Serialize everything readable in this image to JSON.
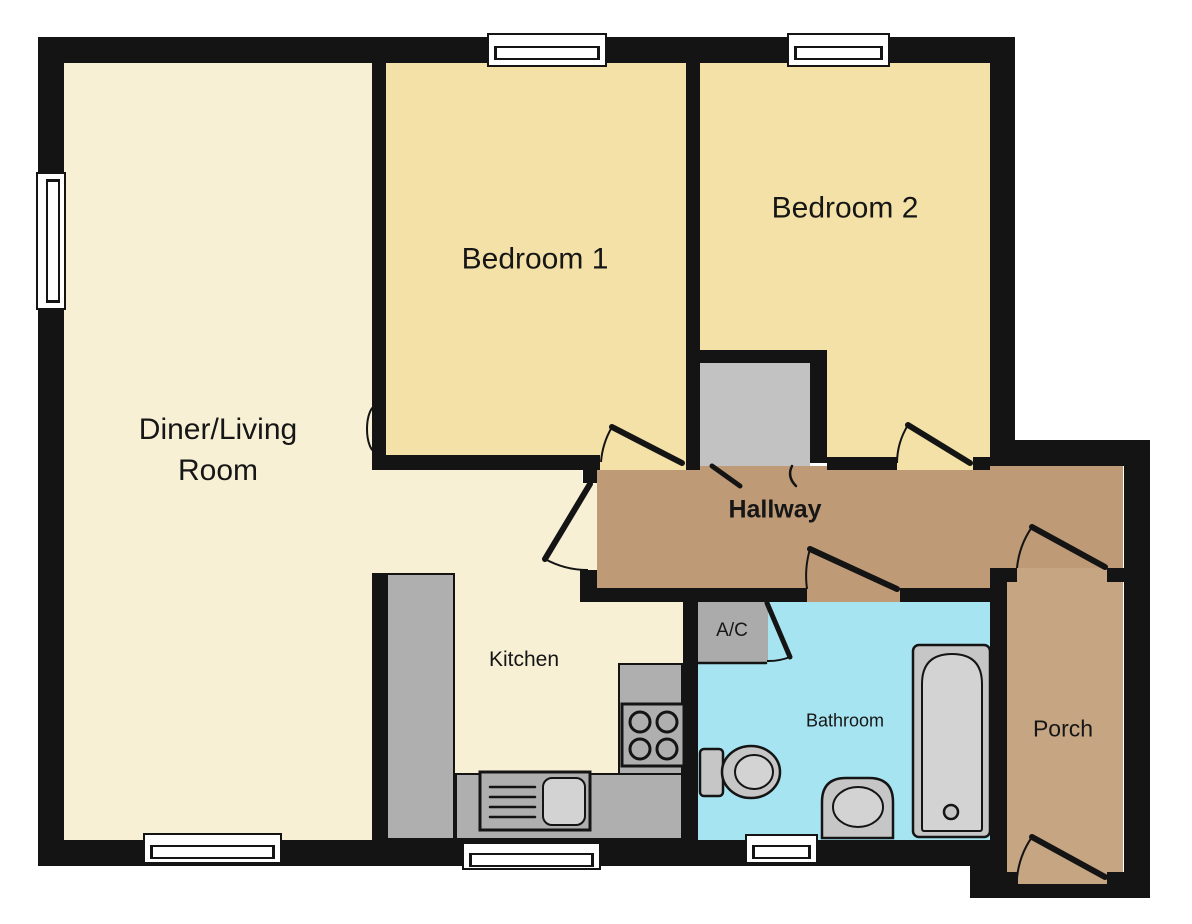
{
  "plan": {
    "labels": {
      "diner_living_line1": "Diner/Living",
      "diner_living_line2": "Room",
      "bedroom1": "Bedroom 1",
      "bedroom2": "Bedroom 2",
      "hallway": "Hallway",
      "kitchen": "Kitchen",
      "ac": "A/C",
      "bathroom": "Bathroom",
      "porch": "Porch"
    },
    "colors": {
      "wall": "#141414",
      "living": "#F7F0D5",
      "bedroom": "#F4E1A7",
      "hallway": "#BE9B76",
      "porch": "#C6A583",
      "bathroom": "#A6E4F1",
      "closet": "#C2C2C2",
      "ac": "#ABABAB",
      "counter": "#AFAFAF",
      "fixture": "#C6C6C6",
      "fixlight": "#D3D3D3",
      "window": "#FFFFFF",
      "background": "#FFFFFF",
      "text": "#161616"
    }
  }
}
